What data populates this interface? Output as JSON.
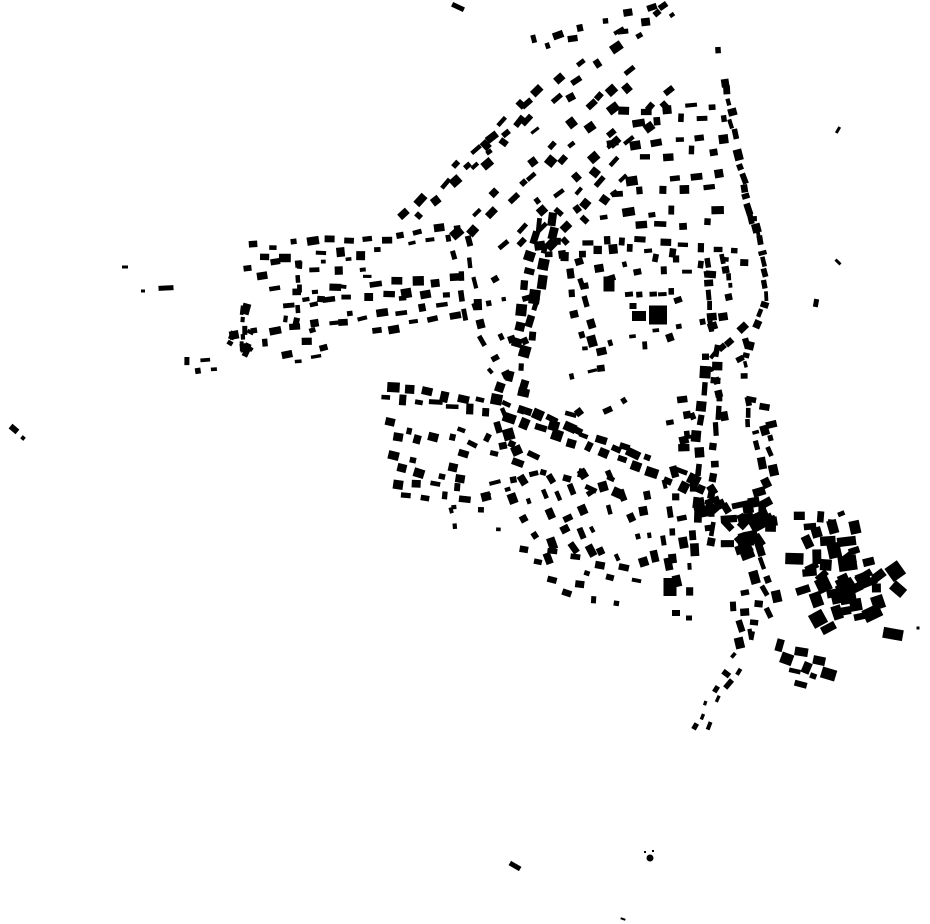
{
  "canvas": {
    "width": 930,
    "height": 924,
    "background_color": "#ffffff",
    "building_color": "#000000",
    "description": "figure-ground building footprint map, black buildings on white"
  },
  "map": {
    "street_format": [
      "id",
      "x1",
      "y1",
      "x2",
      "y2",
      "n",
      "size",
      "row_gap",
      "skip",
      "single_side",
      "rot_jitter"
    ],
    "streets": [
      [
        "T0",
        448,
        192,
        530,
        105,
        9,
        7,
        7,
        0.1,
        0,
        16
      ],
      [
        "T1",
        402,
        222,
        535,
        103,
        15,
        7,
        7,
        0.05,
        0,
        14
      ],
      [
        "T1c",
        535,
        103,
        640,
        25,
        10,
        7,
        8,
        0.2,
        0,
        16
      ],
      [
        "TA",
        528,
        46,
        662,
        13,
        11,
        6,
        7,
        0.25,
        0,
        18
      ],
      [
        "T2",
        455,
        240,
        640,
        72,
        19,
        7,
        7,
        0.08,
        0,
        16
      ],
      [
        "T3",
        505,
        252,
        676,
        90,
        19,
        7,
        7,
        0.08,
        0,
        16
      ],
      [
        "T4",
        548,
        255,
        622,
        170,
        8,
        7,
        7,
        0.1,
        0,
        16
      ],
      [
        "TH1",
        620,
        118,
        730,
        112,
        10,
        7,
        7,
        0.1,
        0,
        14
      ],
      [
        "TH2",
        608,
        152,
        728,
        144,
        11,
        7,
        7,
        0.1,
        0,
        14
      ],
      [
        "TH3",
        602,
        188,
        725,
        180,
        11,
        7,
        7,
        0.1,
        0,
        14
      ],
      [
        "TH4",
        600,
        222,
        735,
        214,
        12,
        7,
        7,
        0.1,
        0,
        14
      ],
      [
        "TR",
        722,
        32,
        742,
        150,
        11,
        7,
        6,
        0.2,
        1,
        16
      ],
      [
        "TRb",
        742,
        150,
        762,
        232,
        8,
        7,
        6,
        0.15,
        1,
        16
      ],
      [
        "H1",
        535,
        250,
        660,
        243,
        15,
        7,
        7,
        0.08,
        0,
        14
      ],
      [
        "H2",
        660,
        246,
        748,
        257,
        10,
        7,
        7,
        0.08,
        0,
        14
      ],
      [
        "L1",
        250,
        252,
        392,
        245,
        15,
        7,
        7,
        0.08,
        0,
        12
      ],
      [
        "L1b",
        396,
        242,
        462,
        231,
        7,
        6,
        6,
        0.1,
        0,
        12
      ],
      [
        "L2",
        243,
        272,
        370,
        262,
        10,
        6,
        6,
        0.25,
        0,
        14
      ],
      [
        "L3",
        272,
        298,
        462,
        285,
        19,
        7,
        7,
        0.12,
        0,
        12
      ],
      [
        "L4",
        228,
        341,
        340,
        330,
        11,
        7,
        7,
        0.1,
        0,
        12
      ],
      [
        "L4b",
        340,
        328,
        458,
        311,
        12,
        7,
        7,
        0.1,
        0,
        12
      ],
      [
        "L5",
        183,
        367,
        218,
        364,
        4,
        6,
        5,
        0.1,
        0,
        12
      ],
      [
        "L5b",
        283,
        358,
        330,
        350,
        5,
        6,
        5,
        0.15,
        0,
        12
      ],
      [
        "C1",
        246,
        306,
        248,
        352,
        5,
        6,
        5,
        0.2,
        1,
        20
      ],
      [
        "C2",
        304,
        262,
        300,
        328,
        6,
        5,
        5,
        0.25,
        1,
        20
      ],
      [
        "C3",
        460,
        238,
        474,
        330,
        9,
        7,
        7,
        0.15,
        0,
        18
      ],
      [
        "J1",
        476,
        340,
        504,
        382,
        5,
        7,
        6,
        0.2,
        0,
        18
      ],
      [
        "C4",
        548,
        213,
        530,
        300,
        11,
        8,
        7,
        0.06,
        0,
        16
      ],
      [
        "C4b",
        530,
        300,
        514,
        388,
        11,
        8,
        7,
        0.06,
        0,
        16
      ],
      [
        "C4e",
        568,
        238,
        590,
        348,
        11,
        7,
        7,
        0.1,
        0,
        16
      ],
      [
        "P2",
        565,
        284,
        645,
        263,
        6,
        6,
        6,
        0.2,
        0,
        16
      ],
      [
        "P2b",
        648,
        263,
        716,
        269,
        6,
        6,
        6,
        0.2,
        0,
        16
      ],
      [
        "PM",
        625,
        292,
        678,
        288,
        5,
        5,
        4,
        0.2,
        1,
        16
      ],
      [
        "E0",
        711,
        258,
        716,
        330,
        7,
        7,
        6,
        0.1,
        1,
        14
      ],
      [
        "E0b",
        728,
        255,
        736,
        300,
        5,
        6,
        6,
        0.2,
        1,
        14
      ],
      [
        "PS",
        582,
        352,
        662,
        336,
        7,
        6,
        6,
        0.2,
        0,
        16
      ],
      [
        "P3",
        652,
        338,
        730,
        318,
        7,
        6,
        6,
        0.2,
        0,
        16
      ],
      [
        "P4",
        731,
        320,
        747,
        362,
        4,
        6,
        6,
        0.2,
        0,
        16
      ],
      [
        "E2",
        760,
        213,
        772,
        300,
        8,
        6,
        6,
        0.15,
        1,
        16
      ],
      [
        "E3",
        770,
        300,
        748,
        360,
        6,
        6,
        6,
        0.15,
        1,
        16
      ],
      [
        "E3b",
        748,
        360,
        756,
        430,
        6,
        6,
        6,
        0.2,
        1,
        16
      ],
      [
        "E4",
        756,
        430,
        781,
        505,
        8,
        7,
        6,
        0.12,
        0,
        16
      ],
      [
        "E5a",
        748,
        326,
        714,
        362,
        5,
        6,
        5,
        0.2,
        1,
        16
      ],
      [
        "E5b",
        714,
        362,
        730,
        420,
        5,
        6,
        5,
        0.3,
        1,
        16
      ],
      [
        "C5",
        712,
        345,
        700,
        555,
        26,
        8,
        8,
        0.06,
        0,
        16
      ],
      [
        "MDa",
        372,
        390,
        500,
        408,
        15,
        8,
        6,
        0.05,
        0,
        12
      ],
      [
        "MDb",
        500,
        408,
        705,
        487,
        26,
        8,
        6,
        0.05,
        0,
        12
      ],
      [
        "MD3",
        490,
        390,
        632,
        442,
        12,
        7,
        7,
        0.2,
        0,
        16
      ],
      [
        "MD2",
        455,
        432,
        625,
        492,
        14,
        7,
        7,
        0.2,
        0,
        16
      ],
      [
        "MDE",
        706,
        488,
        756,
        552,
        7,
        9,
        7,
        0.08,
        0,
        20
      ],
      [
        "A1",
        382,
        428,
        468,
        449,
        8,
        7,
        6,
        0.15,
        0,
        14
      ],
      [
        "A2",
        386,
        458,
        468,
        477,
        8,
        7,
        6,
        0.15,
        0,
        14
      ],
      [
        "A3",
        392,
        488,
        470,
        494,
        8,
        7,
        6,
        0.08,
        0,
        14
      ],
      [
        "A3b",
        470,
        494,
        540,
        478,
        7,
        7,
        6,
        0.08,
        0,
        14
      ],
      [
        "S0",
        497,
        412,
        516,
        467,
        6,
        8,
        7,
        0.08,
        0,
        16
      ],
      [
        "S1",
        512,
        478,
        553,
        560,
        8,
        7,
        7,
        0.1,
        0,
        16
      ],
      [
        "S2",
        541,
        477,
        586,
        561,
        9,
        7,
        7,
        0.1,
        0,
        16
      ],
      [
        "S3",
        572,
        472,
        616,
        564,
        9,
        7,
        7,
        0.1,
        0,
        16
      ],
      [
        "S4",
        604,
        470,
        641,
        567,
        9,
        7,
        7,
        0.1,
        0,
        16
      ],
      [
        "S5",
        637,
        468,
        663,
        574,
        9,
        7,
        7,
        0.1,
        0,
        16
      ],
      [
        "S6",
        668,
        468,
        686,
        598,
        11,
        7,
        7,
        0.1,
        0,
        16
      ],
      [
        "B1",
        518,
        553,
        642,
        576,
        10,
        6,
        6,
        0.25,
        0,
        16
      ],
      [
        "B2",
        545,
        585,
        626,
        601,
        6,
        6,
        6,
        0.3,
        0,
        16
      ],
      [
        "SE1",
        737,
        590,
        748,
        648,
        6,
        7,
        6,
        0.15,
        0,
        16
      ],
      [
        "SE2",
        748,
        648,
        717,
        694,
        6,
        6,
        6,
        0.15,
        0,
        16
      ],
      [
        "SE3",
        716,
        695,
        699,
        733,
        6,
        5,
        5,
        0.15,
        0,
        16
      ],
      [
        "ET",
        762,
        598,
        757,
        650,
        5,
        6,
        5,
        0.2,
        1,
        16
      ],
      [
        "R0",
        795,
        524,
        846,
        516,
        5,
        8,
        6,
        0.2,
        0,
        30
      ],
      [
        "R1",
        792,
        540,
        860,
        530,
        7,
        11,
        7,
        0.1,
        0,
        35
      ],
      [
        "R2",
        791,
        568,
        872,
        553,
        8,
        11,
        7,
        0.1,
        0,
        35
      ],
      [
        "R3",
        800,
        597,
        879,
        579,
        8,
        11,
        7,
        0.1,
        0,
        35
      ],
      [
        "R4",
        812,
        625,
        886,
        606,
        7,
        11,
        7,
        0.1,
        0,
        35
      ],
      [
        "R5",
        774,
        652,
        835,
        668,
        6,
        9,
        6,
        0.1,
        0,
        25
      ],
      [
        "R5b",
        788,
        676,
        818,
        684,
        3,
        7,
        5,
        0.1,
        0,
        20
      ],
      [
        "R6",
        868,
        560,
        906,
        590,
        4,
        11,
        7,
        0.1,
        0,
        35
      ],
      [
        "R7",
        756,
        560,
        776,
        614,
        6,
        8,
        6,
        0.1,
        0,
        20
      ]
    ],
    "cluster_format": [
      "id",
      "cx",
      "cy",
      "rx",
      "ry",
      "n",
      "size",
      "angle"
    ],
    "clusters": [
      [
        "JB",
        735,
        520,
        38,
        42,
        30,
        9,
        -15
      ],
      [
        "BRfill",
        833,
        578,
        50,
        46,
        10,
        10,
        -25
      ],
      [
        "fanfill",
        575,
        150,
        80,
        62,
        10,
        5,
        -40
      ],
      [
        "leftfill",
        340,
        302,
        72,
        34,
        8,
        5,
        -5
      ],
      [
        "tipfill",
        243,
        342,
        18,
        12,
        6,
        6,
        20
      ],
      [
        "midfill",
        505,
        306,
        36,
        46,
        8,
        5,
        -20
      ],
      [
        "south1",
        600,
        392,
        36,
        26,
        6,
        5,
        -20
      ],
      [
        "northMD",
        680,
        420,
        26,
        32,
        8,
        6,
        -10
      ],
      [
        "eastgap",
        763,
        415,
        14,
        30,
        5,
        6,
        0
      ],
      [
        "llsparse",
        470,
        515,
        35,
        25,
        6,
        4,
        0
      ]
    ],
    "single_format": [
      "x",
      "y",
      "w",
      "h",
      "angle",
      "circle"
    ],
    "singles": [
      [
        458,
        7,
        13,
        5,
        25,
        0
      ],
      [
        663,
        6,
        9,
        6,
        -35,
        0
      ],
      [
        672,
        15,
        5,
        4,
        -35,
        0
      ],
      [
        657,
        13,
        7,
        6,
        -40,
        0
      ],
      [
        125,
        267,
        6,
        3,
        0,
        0
      ],
      [
        143,
        291,
        4,
        3,
        0,
        0
      ],
      [
        166,
        288,
        15,
        5,
        -3,
        0
      ],
      [
        246,
        309,
        8,
        11,
        15,
        0
      ],
      [
        14,
        429,
        9,
        6,
        40,
        0
      ],
      [
        23,
        438,
        4,
        4,
        40,
        0
      ],
      [
        838,
        130,
        7,
        3,
        -60,
        0
      ],
      [
        838,
        262,
        7,
        3,
        45,
        0
      ],
      [
        816,
        303,
        5,
        8,
        10,
        0
      ],
      [
        609,
        284,
        11,
        15,
        0,
        0
      ],
      [
        678,
        300,
        8,
        6,
        -20,
        0
      ],
      [
        658,
        315,
        18,
        19,
        0,
        0
      ],
      [
        639,
        316,
        14,
        10,
        0,
        0
      ],
      [
        633,
        306,
        7,
        6,
        0,
        0
      ],
      [
        670,
        587,
        13,
        18,
        0,
        0
      ],
      [
        676,
        613,
        8,
        6,
        0,
        0
      ],
      [
        689,
        618,
        6,
        5,
        0,
        0
      ],
      [
        893,
        634,
        20,
        11,
        10,
        0
      ],
      [
        918,
        628,
        3,
        3,
        0,
        0
      ],
      [
        848,
        597,
        16,
        14,
        -10,
        0
      ],
      [
        845,
        611,
        12,
        8,
        -10,
        0
      ],
      [
        515,
        866,
        12,
        5,
        30,
        0
      ],
      [
        650,
        858,
        7,
        7,
        0,
        1
      ],
      [
        645,
        852,
        2,
        2,
        0,
        0
      ],
      [
        653,
        851,
        2,
        2,
        0,
        0
      ],
      [
        623,
        919,
        5,
        2,
        20,
        0
      ]
    ]
  }
}
